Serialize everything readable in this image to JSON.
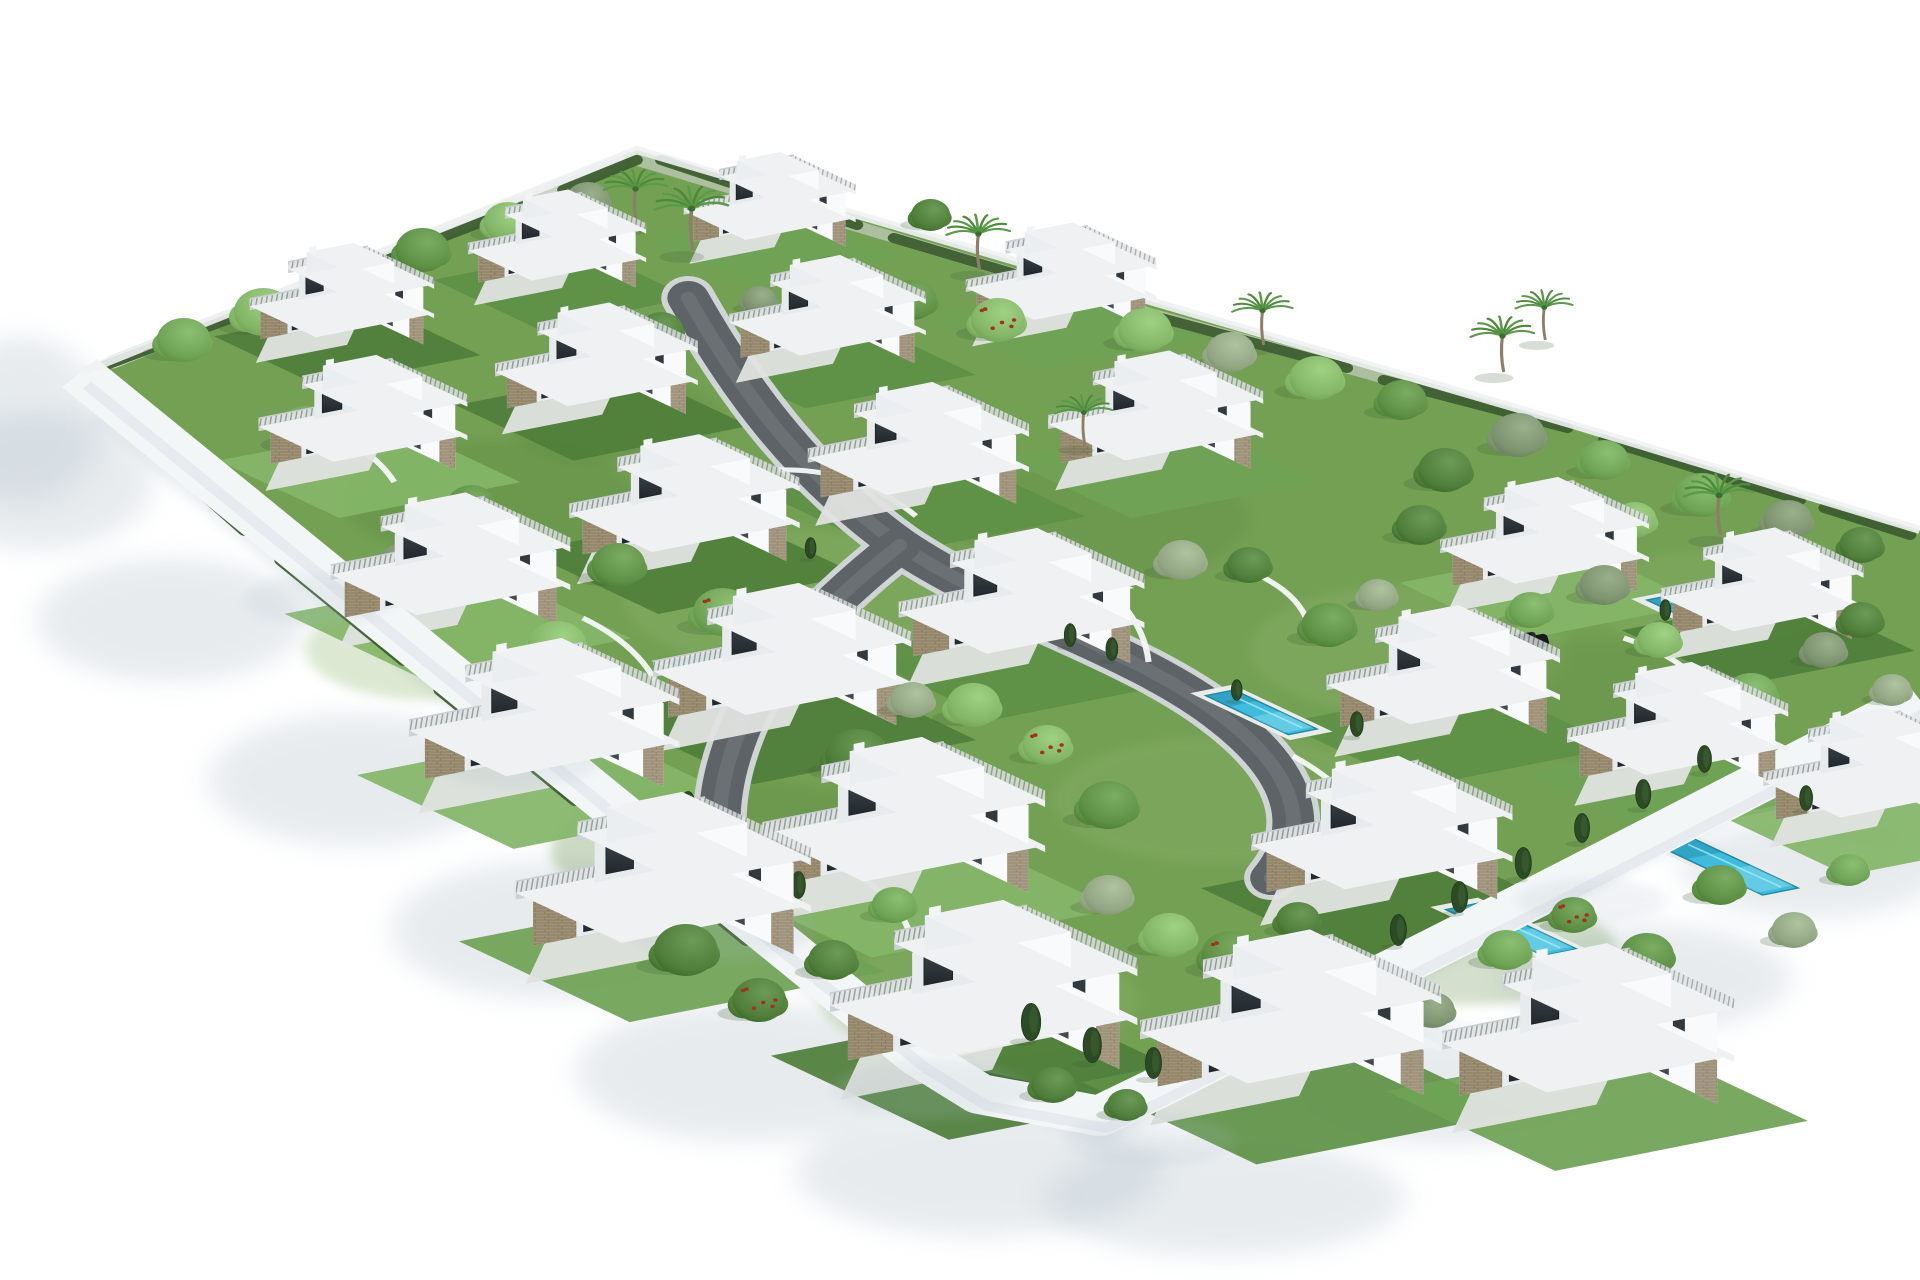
{
  "meta": {
    "description": "Aerial 3D architectural rendering of a gated residential development: rows of white modern three-storey villas with roof terraces, private turquoise pools, green gardens, curved internal roads and a white perimeter wall on a blank white background",
    "villa_count": 25,
    "pool_count": 9
  },
  "palette": {
    "background": "#ffffff",
    "ground": "#74a054",
    "grassDark": "#5d8a42",
    "grassLight": "#8fb56d",
    "wallBand": "#f3f6f7",
    "wallShadow": "#b7c4cd",
    "wallCrisp": "#c2cdd4",
    "bandSpot": "#a9b9c4",
    "road": "#5d6367",
    "roadSheen": "#767c80",
    "curb": "#cfd4d5",
    "lane": "#dadddb",
    "facadeShade": "#e8ebee",
    "facadeLit": "#f9fafb",
    "roof": "#eff1f2",
    "fascia": "#ccd2d6",
    "fasciaLit": "#eef1f2",
    "glassDark": "#2c3236",
    "windowSlit": "#333a3f",
    "stone": "#a0937a",
    "stoneLine": "#857757",
    "railBase": "#e1e5e4",
    "railPost": "#8f969a",
    "railTop": "#c9ced1",
    "apron": "#e0e3e0",
    "water": "#3fbcdb",
    "waterDark": "#1f87a8",
    "waterLight": "#a5ecf8",
    "poolRim": "#eaece8",
    "treeGreens": [
      "#4f7f3a",
      "#5e9146",
      "#6fa355",
      "#84b668"
    ],
    "oliveGreens": [
      "#7e9370",
      "#93a784"
    ],
    "cypress": "#2c4a26",
    "palmGreen": "#4e8a3c",
    "palmGreen2": "#5a9a48",
    "trunk": "#8d7f67",
    "flowerRed": "#a5311f",
    "hedge": "#3e5e31",
    "treeShadow": "#3e5a33",
    "carColors": [
      "#3d2227",
      "#17191b"
    ]
  },
  "plot": {
    "outline": [
      [
        65,
        373
      ],
      [
        520,
        150
      ],
      [
        770,
        240
      ],
      [
        1020,
        330
      ],
      [
        1285,
        425
      ],
      [
        1568,
        530
      ],
      [
        1568,
        700
      ],
      [
        1253,
        898
      ],
      [
        947,
        1087
      ],
      [
        898,
        1116
      ],
      [
        800,
        1094
      ],
      [
        750,
        1056
      ]
    ],
    "wall_path": "M65,373 L750,1056 L800,1094 L898,1116 L947,1087 L1253,898 L1568,700",
    "ne_path": "M65,373 L520,150 L770,240 L1020,330 L1285,425 L1568,530"
  },
  "roads": {
    "main": "M562,298 C600,380 650,470 735,545 C820,615 930,650 1000,718 C1058,773 1072,828 1038,878",
    "branch": "M735,545 C678,600 628,662 606,724 C590,770 584,812 590,852",
    "back_lane": "M92,362 L505,162",
    "top_lane": "M520,160 L905,302 L1180,395"
  },
  "garden_walls": [
    "M636,470 Q700,468 748,516",
    "M862,556 Q932,598 938,662",
    "M1056,756 Q1118,798 1122,852",
    "M476,618 Q530,650 542,702",
    "M1326,638 Q1382,660 1402,704",
    "M238,418 Q300,440 322,482",
    "M688,868 Q730,892 742,930",
    "M1014,568 Q1058,588 1068,622"
  ],
  "villas": [
    [
      300,
      318,
      0.6
    ],
    [
      475,
      262,
      0.58
    ],
    [
      648,
      222,
      0.56
    ],
    [
      320,
      440,
      0.68
    ],
    [
      510,
      385,
      0.66
    ],
    [
      698,
      335,
      0.64
    ],
    [
      888,
      300,
      0.62
    ],
    [
      395,
      590,
      0.78
    ],
    [
      585,
      528,
      0.75
    ],
    [
      775,
      472,
      0.72
    ],
    [
      968,
      438,
      0.7
    ],
    [
      475,
      748,
      0.88
    ],
    [
      668,
      688,
      0.84
    ],
    [
      862,
      628,
      0.8
    ],
    [
      575,
      912,
      0.96
    ],
    [
      770,
      852,
      0.92
    ],
    [
      838,
      1025,
      1.0
    ],
    [
      1088,
      1052,
      0.98
    ],
    [
      1330,
      1062,
      0.95
    ],
    [
      1285,
      562,
      0.68
    ],
    [
      1462,
      610,
      0.66
    ],
    [
      1205,
      700,
      0.76
    ],
    [
      1395,
      752,
      0.72
    ],
    [
      1552,
      795,
      0.7
    ],
    [
      1158,
      862,
      0.85
    ]
  ],
  "pools": [
    [
      810,
      595,
      85,
      24,
      "A"
    ],
    [
      545,
      662,
      80,
      22,
      "A"
    ],
    [
      1008,
      690,
      78,
      24,
      "B"
    ],
    [
      1345,
      600,
      110,
      28,
      "A"
    ],
    [
      1382,
      838,
      100,
      30,
      "B"
    ],
    [
      1208,
      903,
      92,
      28,
      "B"
    ],
    [
      745,
      1042,
      95,
      26,
      "A"
    ],
    [
      520,
      846,
      65,
      20,
      "A"
    ],
    [
      462,
      370,
      55,
      16,
      "A"
    ]
  ],
  "trees": [
    [
      "d",
      150,
      340,
      22
    ],
    [
      "d",
      215,
      312,
      24
    ],
    [
      "o",
      275,
      288,
      20
    ],
    [
      "d",
      345,
      250,
      22
    ],
    [
      "d",
      415,
      222,
      20
    ],
    [
      "o",
      480,
      200,
      18
    ],
    [
      "d",
      680,
      280,
      24
    ],
    [
      "d",
      745,
      300,
      20
    ],
    [
      "f",
      815,
      320,
      22
    ],
    [
      "d",
      935,
      330,
      22
    ],
    [
      "o",
      1005,
      352,
      20
    ],
    [
      "d",
      1075,
      378,
      22
    ],
    [
      "d",
      1145,
      400,
      20
    ],
    [
      "o",
      1240,
      435,
      22
    ],
    [
      "d",
      1310,
      460,
      20
    ],
    [
      "d",
      1390,
      495,
      22
    ],
    [
      "o",
      1460,
      520,
      20
    ],
    [
      "d",
      1520,
      545,
      18
    ],
    [
      "d",
      250,
      430,
      24
    ],
    [
      "o",
      330,
      565,
      22
    ],
    [
      "d",
      385,
      505,
      20
    ],
    [
      "d",
      455,
      645,
      24
    ],
    [
      "o",
      545,
      480,
      18
    ],
    [
      "d",
      505,
      565,
      22
    ],
    [
      "f",
      590,
      612,
      24
    ],
    [
      "d",
      640,
      645,
      20
    ],
    [
      "o",
      610,
      520,
      16
    ],
    [
      "d",
      700,
      755,
      26
    ],
    [
      "o",
      745,
      700,
      18
    ],
    [
      "d",
      795,
      705,
      22
    ],
    [
      "f",
      855,
      745,
      20
    ],
    [
      "d",
      905,
      805,
      24
    ],
    [
      "o",
      965,
      560,
      20
    ],
    [
      "d",
      1020,
      565,
      18
    ],
    [
      "d",
      1085,
      625,
      22
    ],
    [
      "o",
      1125,
      595,
      16
    ],
    [
      "d",
      1160,
      525,
      20
    ],
    [
      "d",
      1250,
      610,
      18
    ],
    [
      "o",
      1310,
      585,
      20
    ],
    [
      "d",
      1355,
      640,
      18
    ],
    [
      "d",
      1430,
      695,
      22
    ],
    [
      "o",
      1490,
      650,
      18
    ],
    [
      "d",
      560,
      950,
      26
    ],
    [
      "f",
      620,
      1000,
      22
    ],
    [
      "d",
      680,
      960,
      20
    ],
    [
      "d",
      730,
      905,
      18
    ],
    [
      "o",
      905,
      895,
      20
    ],
    [
      "d",
      955,
      935,
      22
    ],
    [
      "f",
      1005,
      955,
      24
    ],
    [
      "d",
      1060,
      920,
      18
    ],
    [
      "d",
      1115,
      1000,
      22
    ],
    [
      "o",
      1170,
      1010,
      18
    ],
    [
      "d",
      1230,
      950,
      20
    ],
    [
      "f",
      1285,
      915,
      18
    ],
    [
      "d",
      1345,
      955,
      22
    ],
    [
      "d",
      1405,
      885,
      20
    ],
    [
      "o",
      1465,
      930,
      18
    ],
    [
      "d",
      1510,
      870,
      16
    ],
    [
      "d",
      860,
      1085,
      18
    ],
    [
      "d",
      920,
      1105,
      16
    ],
    [
      "d",
      540,
      330,
      18
    ],
    [
      "o",
      620,
      300,
      14
    ],
    [
      "d",
      870,
      255,
      18
    ],
    [
      "d",
      760,
      215,
      16
    ],
    [
      "d",
      1180,
      470,
      22
    ],
    [
      "o",
      1260,
      520,
      18
    ],
    [
      "d",
      1335,
      520,
      18
    ],
    [
      "d",
      1440,
      570,
      20
    ],
    [
      "d",
      1520,
      620,
      18
    ],
    [
      "o",
      1545,
      690,
      16
    ]
  ],
  "palms": [
    [
      520,
      225,
      1.0
    ],
    [
      566,
      250,
      1.15
    ],
    [
      800,
      270,
      1.0
    ],
    [
      1032,
      345,
      0.95
    ],
    [
      1228,
      372,
      1.0
    ],
    [
      1262,
      340,
      0.9
    ],
    [
      1405,
      535,
      1.1
    ],
    [
      886,
      445,
      0.9
    ]
  ],
  "cypresses": [
    [
      757,
      988,
      30
    ],
    [
      798,
      1012,
      34
    ],
    [
      842,
      1040,
      36
    ],
    [
      892,
      1062,
      34
    ],
    [
      942,
      1078,
      30
    ],
    [
      992,
      1048,
      32
    ],
    [
      1042,
      1014,
      34
    ],
    [
      1092,
      980,
      32
    ],
    [
      1142,
      945,
      30
    ],
    [
      1192,
      912,
      30
    ],
    [
      1244,
      878,
      30
    ],
    [
      616,
      872,
      28
    ],
    [
      652,
      898,
      26
    ],
    [
      562,
      818,
      26
    ],
    [
      484,
      734,
      24
    ],
    [
      1292,
      842,
      28
    ],
    [
      1342,
      808,
      28
    ],
    [
      1392,
      772,
      26
    ],
    [
      1444,
      738,
      26
    ],
    [
      874,
      646,
      22
    ],
    [
      908,
      660,
      22
    ],
    [
      1108,
      736,
      24
    ],
    [
      662,
      558,
      20
    ],
    [
      1010,
      700,
      20
    ],
    [
      1360,
      620,
      20
    ],
    [
      700,
      795,
      22
    ],
    [
      505,
      855,
      22
    ],
    [
      1475,
      810,
      24
    ],
    [
      1510,
      775,
      22
    ]
  ],
  "hedges": [
    [
      110,
      432,
      200,
      530,
      12
    ],
    [
      230,
      560,
      330,
      660,
      12
    ],
    [
      360,
      690,
      470,
      800,
      12
    ],
    [
      500,
      830,
      610,
      940,
      12
    ],
    [
      640,
      965,
      730,
      1055,
      12
    ],
    [
      760,
      1065,
      900,
      1105,
      12
    ],
    [
      910,
      1108,
      948,
      1084,
      10
    ],
    [
      960,
      1075,
      1120,
      975,
      12
    ],
    [
      1150,
      955,
      1300,
      860,
      12
    ],
    [
      1330,
      840,
      1470,
      752,
      12
    ],
    [
      1490,
      740,
      1560,
      700,
      12
    ],
    [
      80,
      368,
      250,
      290,
      10
    ],
    [
      280,
      275,
      430,
      205,
      10
    ],
    [
      460,
      190,
      520,
      160,
      10
    ],
    [
      540,
      160,
      700,
      225,
      10
    ],
    [
      730,
      238,
      900,
      300,
      10
    ],
    [
      930,
      312,
      1100,
      368,
      10
    ],
    [
      1130,
      380,
      1280,
      428,
      10
    ],
    [
      1310,
      440,
      1470,
      500,
      10
    ],
    [
      1490,
      508,
      1560,
      535,
      10
    ]
  ],
  "grass_patches": [
    [
      400,
      500,
      120,
      60,
      "#5d8a42",
      0.35
    ],
    [
      650,
      600,
      140,
      70,
      "#8fb56d",
      0.3
    ],
    [
      900,
      520,
      120,
      60,
      "#5d8a42",
      0.3
    ],
    [
      1150,
      650,
      130,
      65,
      "#8fb56d",
      0.3
    ],
    [
      600,
      850,
      150,
      70,
      "#5d8a42",
      0.3
    ],
    [
      1000,
      800,
      140,
      65,
      "#8fb56d",
      0.28
    ],
    [
      1300,
      700,
      120,
      60,
      "#5d8a42",
      0.28
    ],
    [
      800,
      1000,
      130,
      60,
      "#8fb56d",
      0.3
    ],
    [
      1200,
      950,
      120,
      55,
      "#5d8a42",
      0.26
    ],
    [
      350,
      650,
      100,
      50,
      "#8fb56d",
      0.3
    ],
    [
      500,
      420,
      90,
      45,
      "#5d8a42",
      0.3
    ],
    [
      1400,
      600,
      100,
      50,
      "#8fb56d",
      0.26
    ]
  ],
  "shadows": {
    "blobs": [
      [
        30,
        480,
        95,
        70
      ],
      [
        140,
        620,
        110,
        62
      ],
      [
        290,
        780,
        120,
        66
      ],
      [
        450,
        930,
        130,
        70
      ],
      [
        610,
        1072,
        140,
        70
      ],
      [
        800,
        1172,
        150,
        64
      ],
      [
        1000,
        1198,
        148,
        58
      ],
      [
        1185,
        1088,
        128,
        58
      ],
      [
        1345,
        978,
        118,
        54
      ],
      [
        1480,
        868,
        108,
        50
      ],
      [
        1556,
        806,
        88,
        44
      ],
      [
        18,
        420,
        66,
        84
      ]
    ],
    "blob_opacity": 0.32,
    "crisp_path": "M82,412 L756,1072 L900,1132 L952,1096 L1560,716",
    "band_spots": [
      [
        260,
        600,
        60,
        26
      ],
      [
        420,
        760,
        70,
        28
      ],
      [
        590,
        930,
        76,
        30
      ],
      [
        760,
        1090,
        80,
        30
      ],
      [
        940,
        1140,
        70,
        26
      ],
      [
        1120,
        1020,
        66,
        24
      ],
      [
        1300,
        900,
        62,
        22
      ]
    ]
  },
  "cars": [
    [
      828,
      612,
      0
    ],
    [
      1247,
      644,
      1
    ]
  ]
}
